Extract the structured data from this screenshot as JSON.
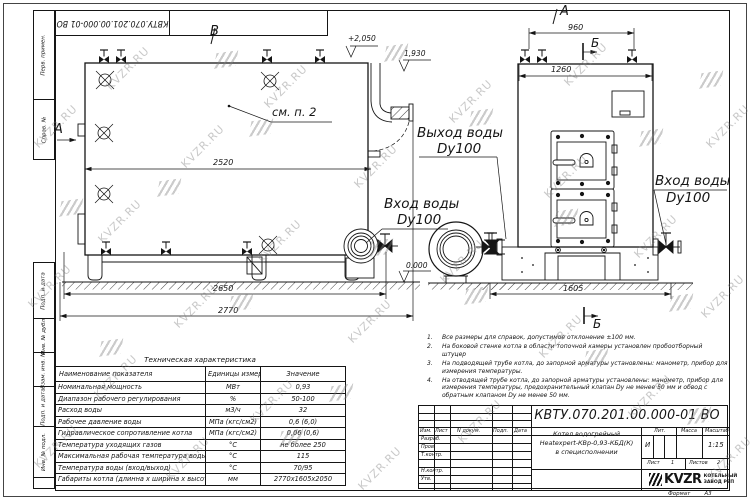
{
  "doc": {
    "number": "КВТУ.070.201.00.000-01 ВО",
    "format_label": "Формат",
    "format_value": "А3"
  },
  "watermark": {
    "text": "KVZR.RU"
  },
  "side_strip": {
    "cells": [
      "Перв. примен.",
      "Справ. №",
      "Подп. и дата",
      "Инв. № дубл.",
      "Взам. инв. №",
      "Подп. и дата",
      "Инв. № подл."
    ]
  },
  "drawing": {
    "view_b_label": "В",
    "view_a_side_label": "А",
    "view_a_front_label": "А",
    "section_b_top_label": "Б",
    "section_b_bottom_label": "Б",
    "see_note": "см. п. 2",
    "elev_top": "+2,050",
    "elev_mid": "1,930",
    "elev_zero": "0.000",
    "water_outlet_line1": "Выход воды",
    "water_outlet_line2": "Dy100",
    "water_inlet_side_line1": "Вход воды",
    "water_inlet_side_line2": "Dy100",
    "water_inlet_front_line1": "Вход воды",
    "water_inlet_front_line2": "Dy100",
    "dims": {
      "d2520": "2520",
      "d2650": "2650",
      "d2770": "2770",
      "d960": "960",
      "d1260": "1260",
      "d1605": "1605"
    }
  },
  "table": {
    "title": "Техническая характеристика",
    "headers": [
      "Наименование показателя",
      "Единицы измерения",
      "Значение"
    ],
    "rows": [
      {
        "name": "Номинальная мощность",
        "unit": "МВт",
        "value": "0,93"
      },
      {
        "name": "Диапазон рабочего регулирования",
        "unit": "%",
        "value": "50-100"
      },
      {
        "name": "Расход воды",
        "unit": "м3/ч",
        "value": "32"
      },
      {
        "name": "Рабочее давление воды",
        "unit": "МПа (кгс/см2)",
        "value": "0,6 (6,0)"
      },
      {
        "name": "Гидравлическое сопротивление котла",
        "unit": "МПа (кгс/см2)",
        "value": "0,06 (0,6)"
      },
      {
        "name": "Температура уходящих газов",
        "unit": "°С",
        "value": "не более 250"
      },
      {
        "name": "Максимальная рабочая температура воды",
        "unit": "°С",
        "value": "115"
      },
      {
        "name": "Температура воды (вход/выход)",
        "unit": "°С",
        "value": "70/95"
      },
      {
        "name": "Габариты котла (длинна х ширина х высота)",
        "unit": "мм",
        "value": "2770х1605х2050"
      }
    ]
  },
  "notes": {
    "items": [
      {
        "num": "1.",
        "text": "Все размеры для справок, допустимое отклонение ±100 мм."
      },
      {
        "num": "2.",
        "text": "На боковой стенке котла в области топочной камеры установлен пробоотборный штуцер"
      },
      {
        "num": "3.",
        "text": "На подводящей трубе котла, до запорной арматуры установлены: манометр, прибор для измерения температуры."
      },
      {
        "num": "4.",
        "text": "На отводящей трубе котла, до запорной арматуры установлены: манометр, прибор для измерения температуры, предохранительный клапан Dу не менее 50 мм и обвод с обратным клапаном Dу не менее 50 мм."
      }
    ]
  },
  "title_block": {
    "doc_number": "КВТУ.070.201.00.000-01 ВО",
    "col_izm": "Изм.",
    "col_list": "Лист",
    "col_ndoc": "N докум.",
    "col_podp": "Подп.",
    "col_data": "Дата",
    "row_razrab": "Разраб.",
    "row_prov": "Пров.",
    "row_tkontr": "Т.контр.",
    "row_nkontr": "Н.контр.",
    "row_utv": "Утв.",
    "title_line1": "Котел водогрейный",
    "title_line2": "Heatexpert-КВр-0,93-КБД(К)",
    "title_line3": "в специсполнении",
    "lit_label": "Лит.",
    "lit_value": "И",
    "massa_label": "Масса",
    "masshtab_label": "Масштаб",
    "masshtab_value": "1:15",
    "list_label": "Лист",
    "list_value": "1",
    "listov_label": "Листов",
    "listov_value": "2",
    "logo_text": "KVZR",
    "company_line1": "КОТЕЛЬНЫЙ",
    "company_line2": "ЗАВОД РЭП"
  }
}
